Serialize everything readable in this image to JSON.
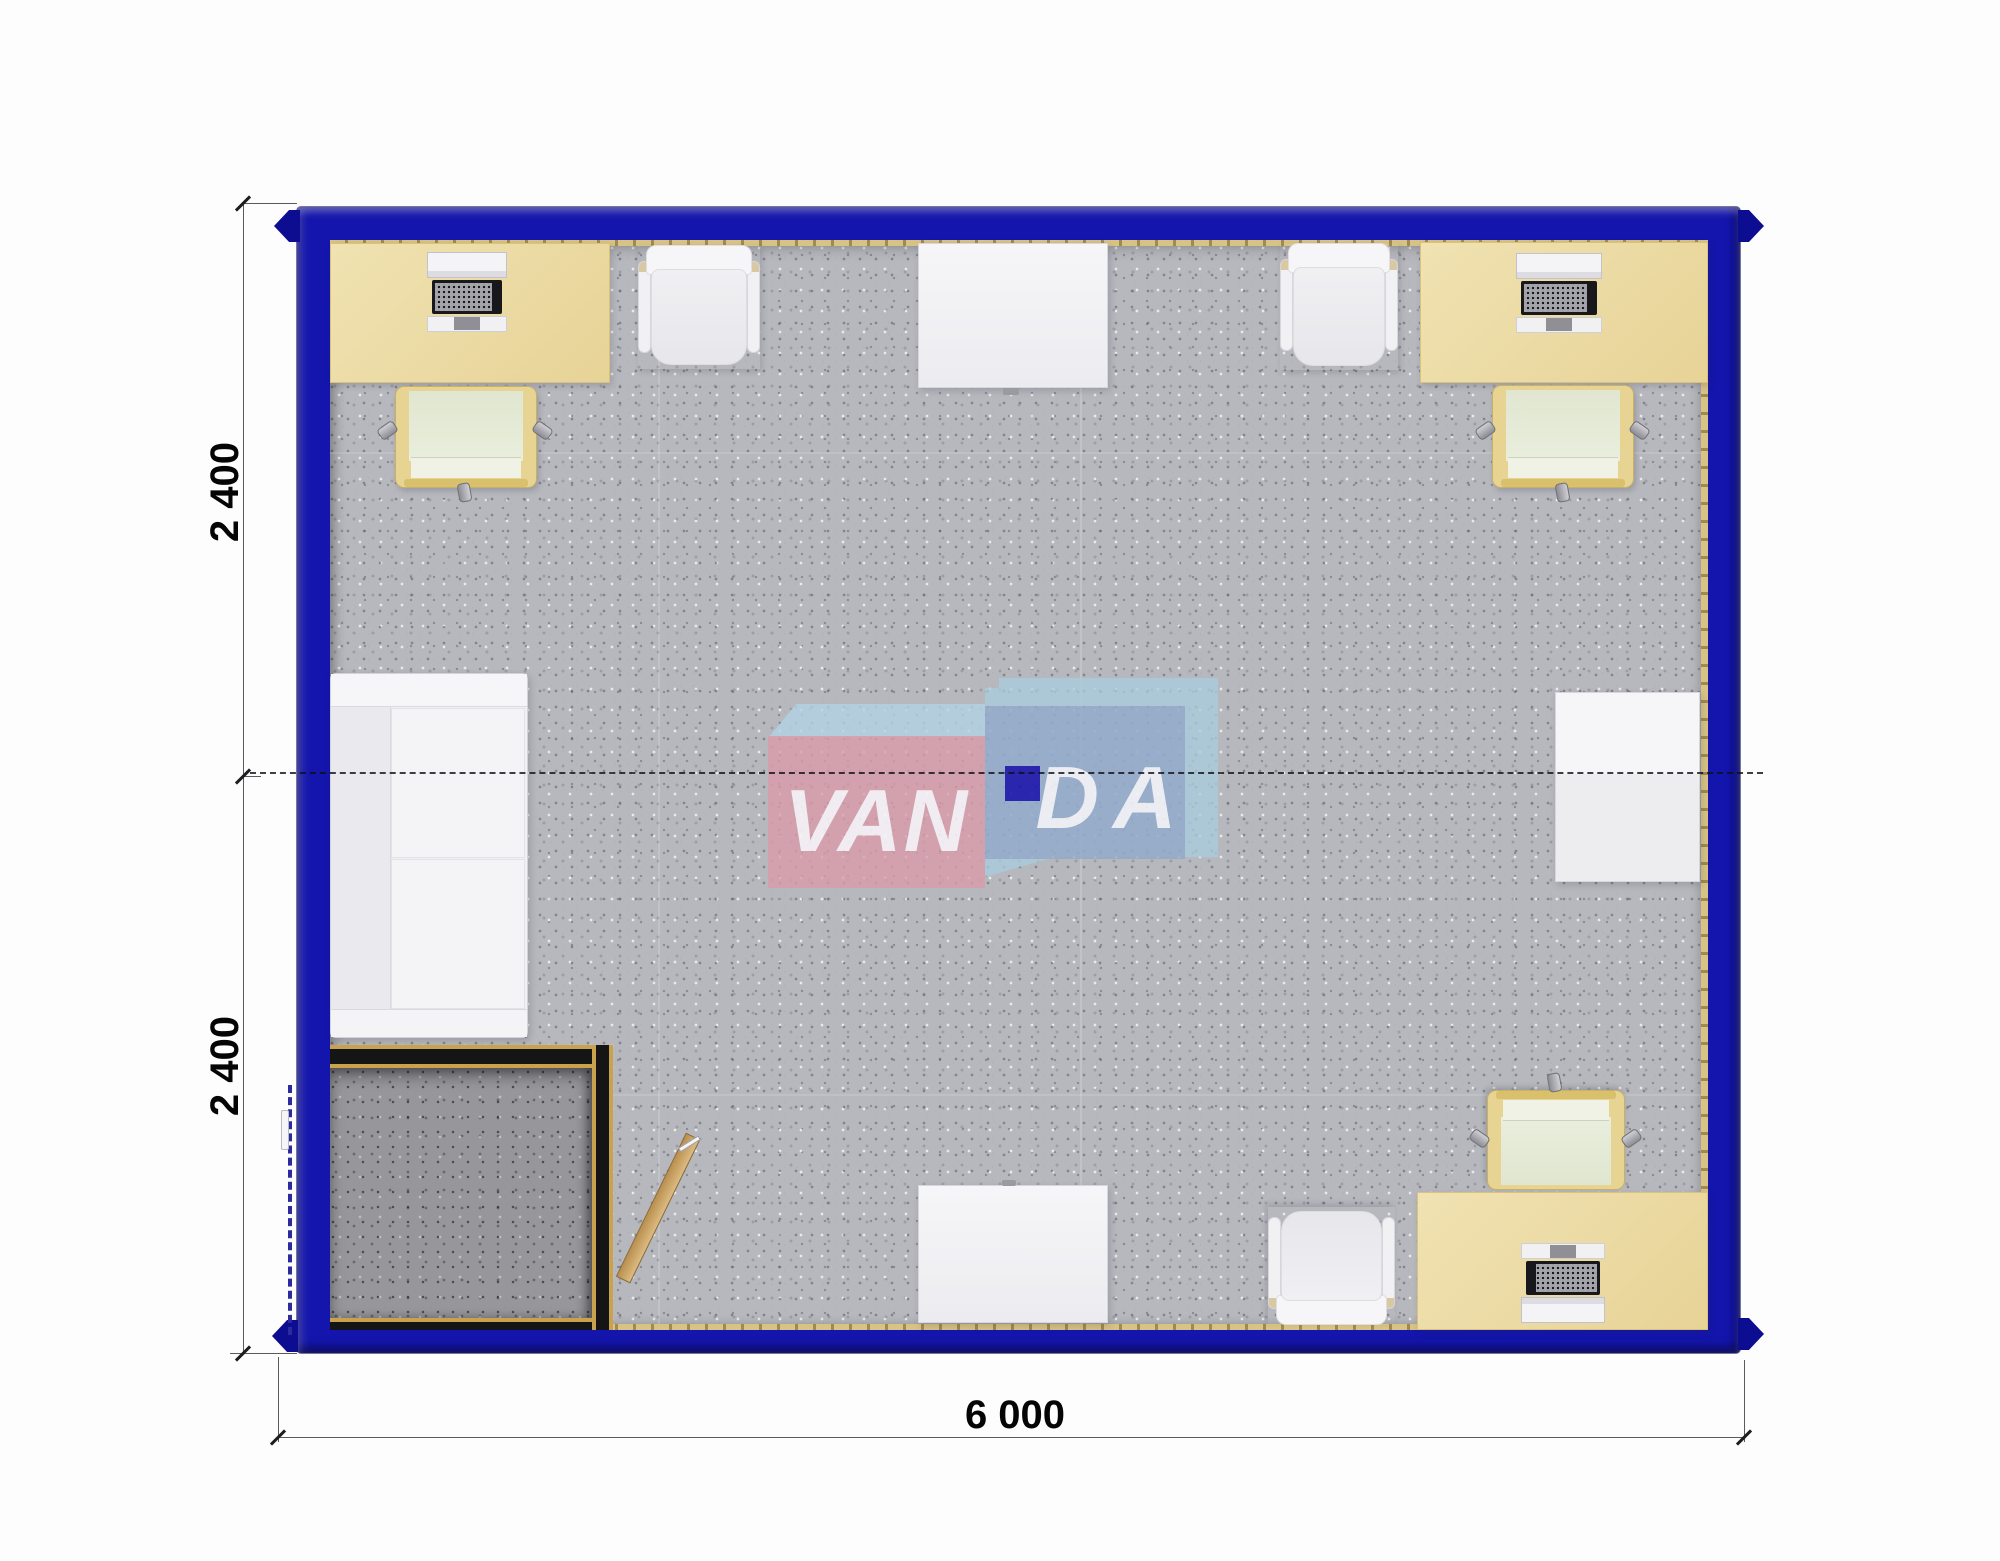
{
  "plan": {
    "watermark": {
      "left_text": "VAN",
      "right_text": "DA",
      "brand": "VANDA"
    },
    "dimensions": {
      "left_top_label": "2 400",
      "left_bottom_label": "2 400",
      "bottom_label": "6 000"
    },
    "colors": {
      "frame_blue": "#1415ac",
      "carpet_gray": "#b7b8bd",
      "entry_floor_gray": "#97979b",
      "desk_beige": "#ead9a2",
      "wood_trim_gold": "#c8a24c",
      "door_wood": "#c9a05c",
      "logo_pink": "#db9ba9",
      "logo_light_blue": "#a9cbde",
      "logo_mid_blue": "#8ea4c6",
      "logo_navy_square": "#1c17ad",
      "furniture_white": "#f3f3f5",
      "task_chair_beige": "#e7d493"
    },
    "rooms": [
      "main office room",
      "entry vestibule"
    ],
    "furniture_inventory": [
      "desk x3",
      "desktop computer x3",
      "office task chair x3",
      "guest chair x3",
      "white side table x3",
      "sofa x1",
      "entry door x1"
    ]
  }
}
